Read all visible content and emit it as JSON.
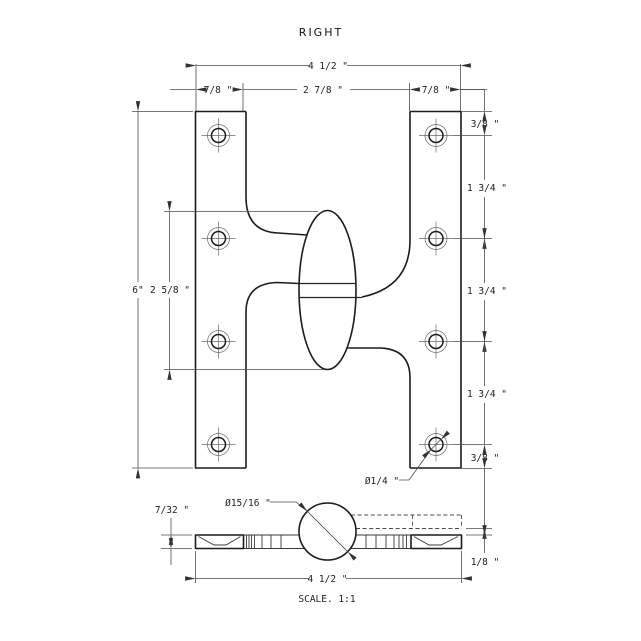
{
  "title": "RIGHT",
  "scale_label": "SCALE. 1:1",
  "colors": {
    "background": "#ffffff",
    "object_line": "#1c1c1c",
    "dimension_line": "#4d4d4d",
    "text": "#1f1f1f"
  },
  "front_view": {
    "width_total": "4 1/2 \"",
    "leaf_width_left": "7/8 \"",
    "gap_width": "2 7/8 \"",
    "leaf_width_right": "7/8 \"",
    "height_total": "6\"",
    "knuckle_height": "2 5/8 \"",
    "edge_to_hole_top": "3/8 \"",
    "hole_spacing_1": "1 3/4 \"",
    "hole_spacing_2": "1 3/4 \"",
    "hole_spacing_3": "1 3/4 \"",
    "hole_to_edge_bottom": "3/8 \"",
    "hole_diameter": "Ø1/4 \""
  },
  "bottom_view": {
    "knuckle_diameter": "Ø15/16 \"",
    "leaf_thickness": "7/32 \"",
    "leaf_offset": "1/8 \"",
    "width_total": "4 1/2 \""
  }
}
